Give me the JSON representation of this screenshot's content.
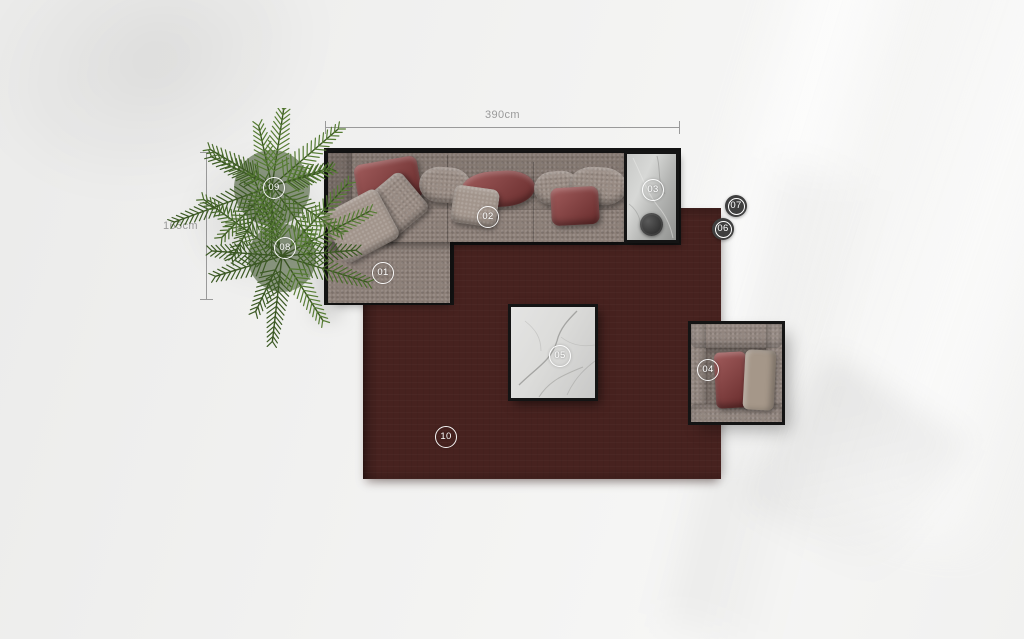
{
  "annotations": {
    "width_dimension": "390cm",
    "height_dimension": "165cm"
  },
  "markers": [
    {
      "label": "01",
      "style": "outline",
      "x": 383,
      "y": 273
    },
    {
      "label": "02",
      "style": "outline",
      "x": 488,
      "y": 217
    },
    {
      "label": "03",
      "style": "outline",
      "x": 653,
      "y": 190
    },
    {
      "label": "04",
      "style": "outline",
      "x": 708,
      "y": 370
    },
    {
      "label": "05",
      "style": "outline",
      "x": 560,
      "y": 356
    },
    {
      "label": "06",
      "style": "dark",
      "x": 723,
      "y": 229
    },
    {
      "label": "07",
      "style": "dark",
      "x": 736,
      "y": 206
    },
    {
      "label": "08",
      "style": "outline",
      "x": 285,
      "y": 248
    },
    {
      "label": "09",
      "style": "outline",
      "x": 274,
      "y": 188
    },
    {
      "label": "10",
      "style": "outline",
      "x": 446,
      "y": 437
    }
  ],
  "colors": {
    "rug": "#47221f",
    "sofa_fabric": "#8c7f78",
    "pillow_red": "#8e3c3c",
    "pillow_taupe": "#988b83",
    "frame": "#141414",
    "marble_light": "#dcdcda",
    "marble_dark": "#b4b5b3",
    "plant_greens": [
      "#3c5a24",
      "#4a6c2c",
      "#567c33"
    ],
    "badge_dark": "#3f3f3f",
    "dimension": "#9a9a9a"
  }
}
